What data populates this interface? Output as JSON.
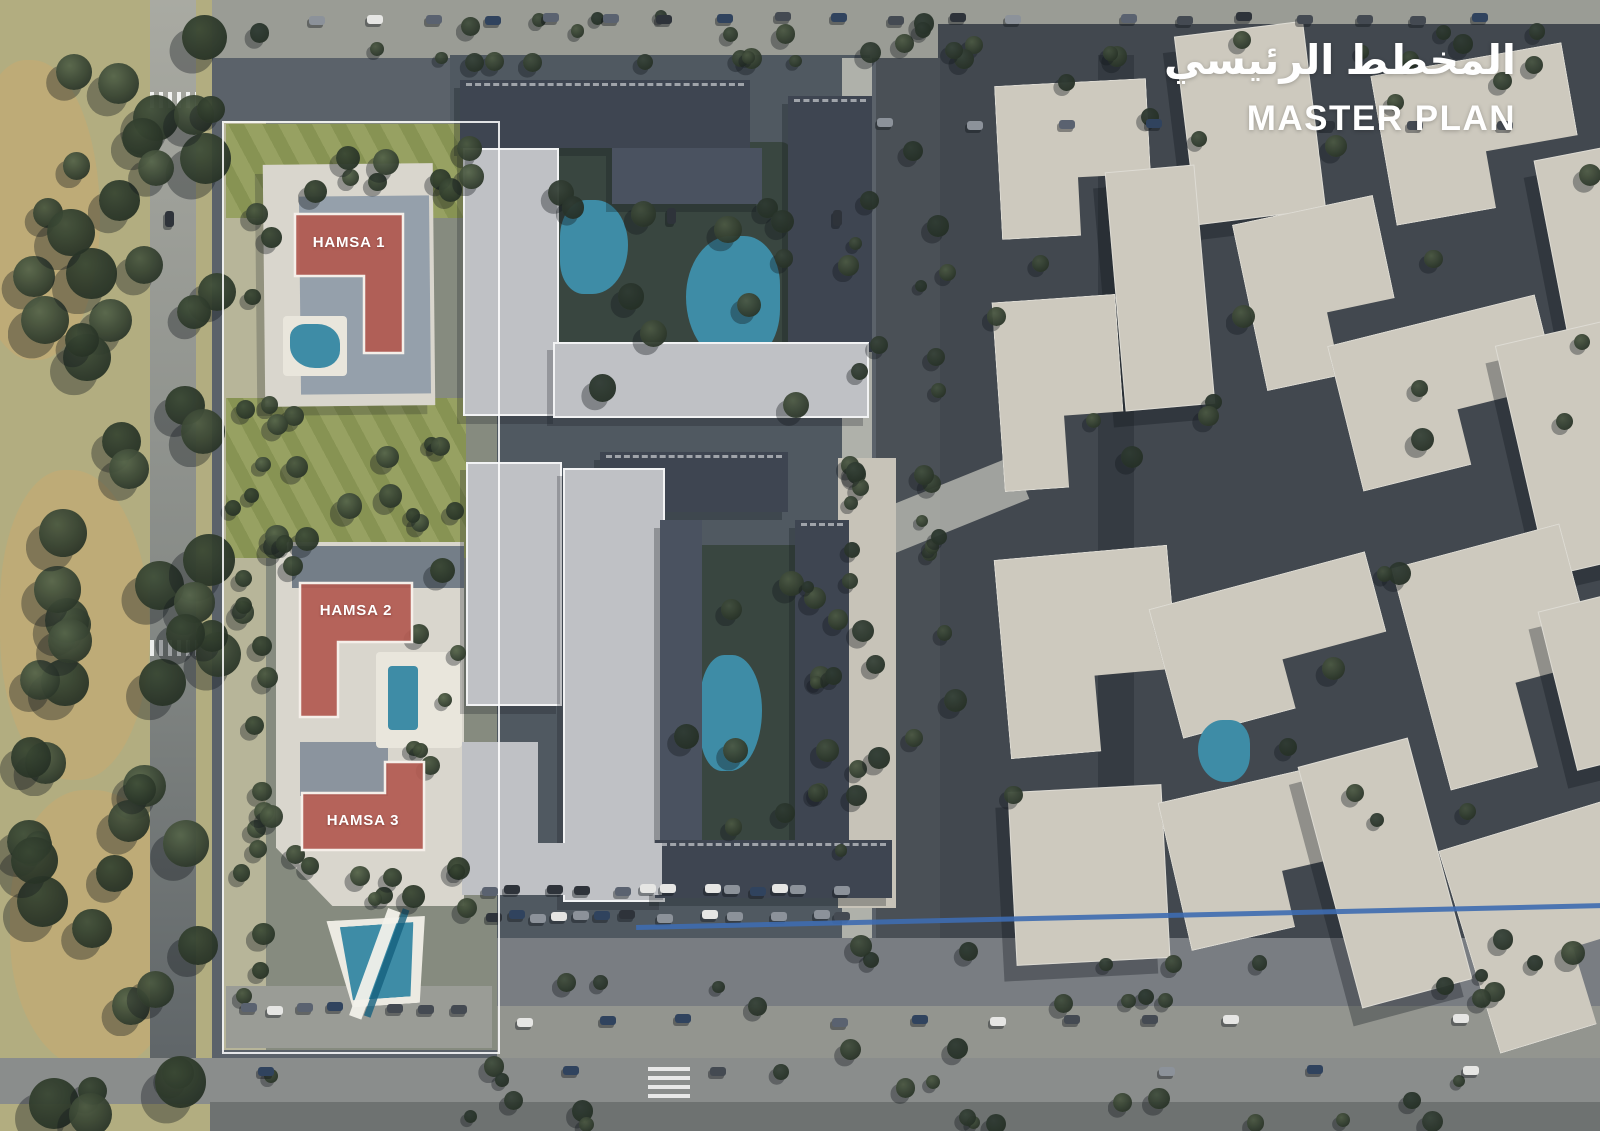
{
  "title": {
    "arabic": "المخطط الرئيسي",
    "english": "MASTER PLAN"
  },
  "hamsa": [
    {
      "label": "HAMSA 1"
    },
    {
      "label": "HAMSA 2"
    },
    {
      "label": "HAMSA 3"
    }
  ],
  "palette": {
    "highlight": "#b15a51",
    "highlightStroke": "#f5efe9",
    "titleColor": "#ffffff",
    "pool": "#3e8ca6",
    "poolDeck": "#e9e6dc",
    "groundBase": "#5b626a",
    "groundCentral": "#505961",
    "groundEast": "#42484f",
    "park": "#b2ad80",
    "parkSand": "#c2ab74",
    "roadLight": "#9a9c95",
    "roadMid": "#797d82",
    "roadBottom": "#8a8d8c",
    "sidewalk": "#93958f",
    "platform": "#d9d6cd",
    "roofDark": "#3e4551",
    "roofLight": "#bfc1c5",
    "roofBeige": "#cdc9be",
    "court": "#394640",
    "lawn": "#97a162",
    "lawnDark": "#879353",
    "blueLane": "#3e6cb0",
    "parking": "#4a5056"
  }
}
